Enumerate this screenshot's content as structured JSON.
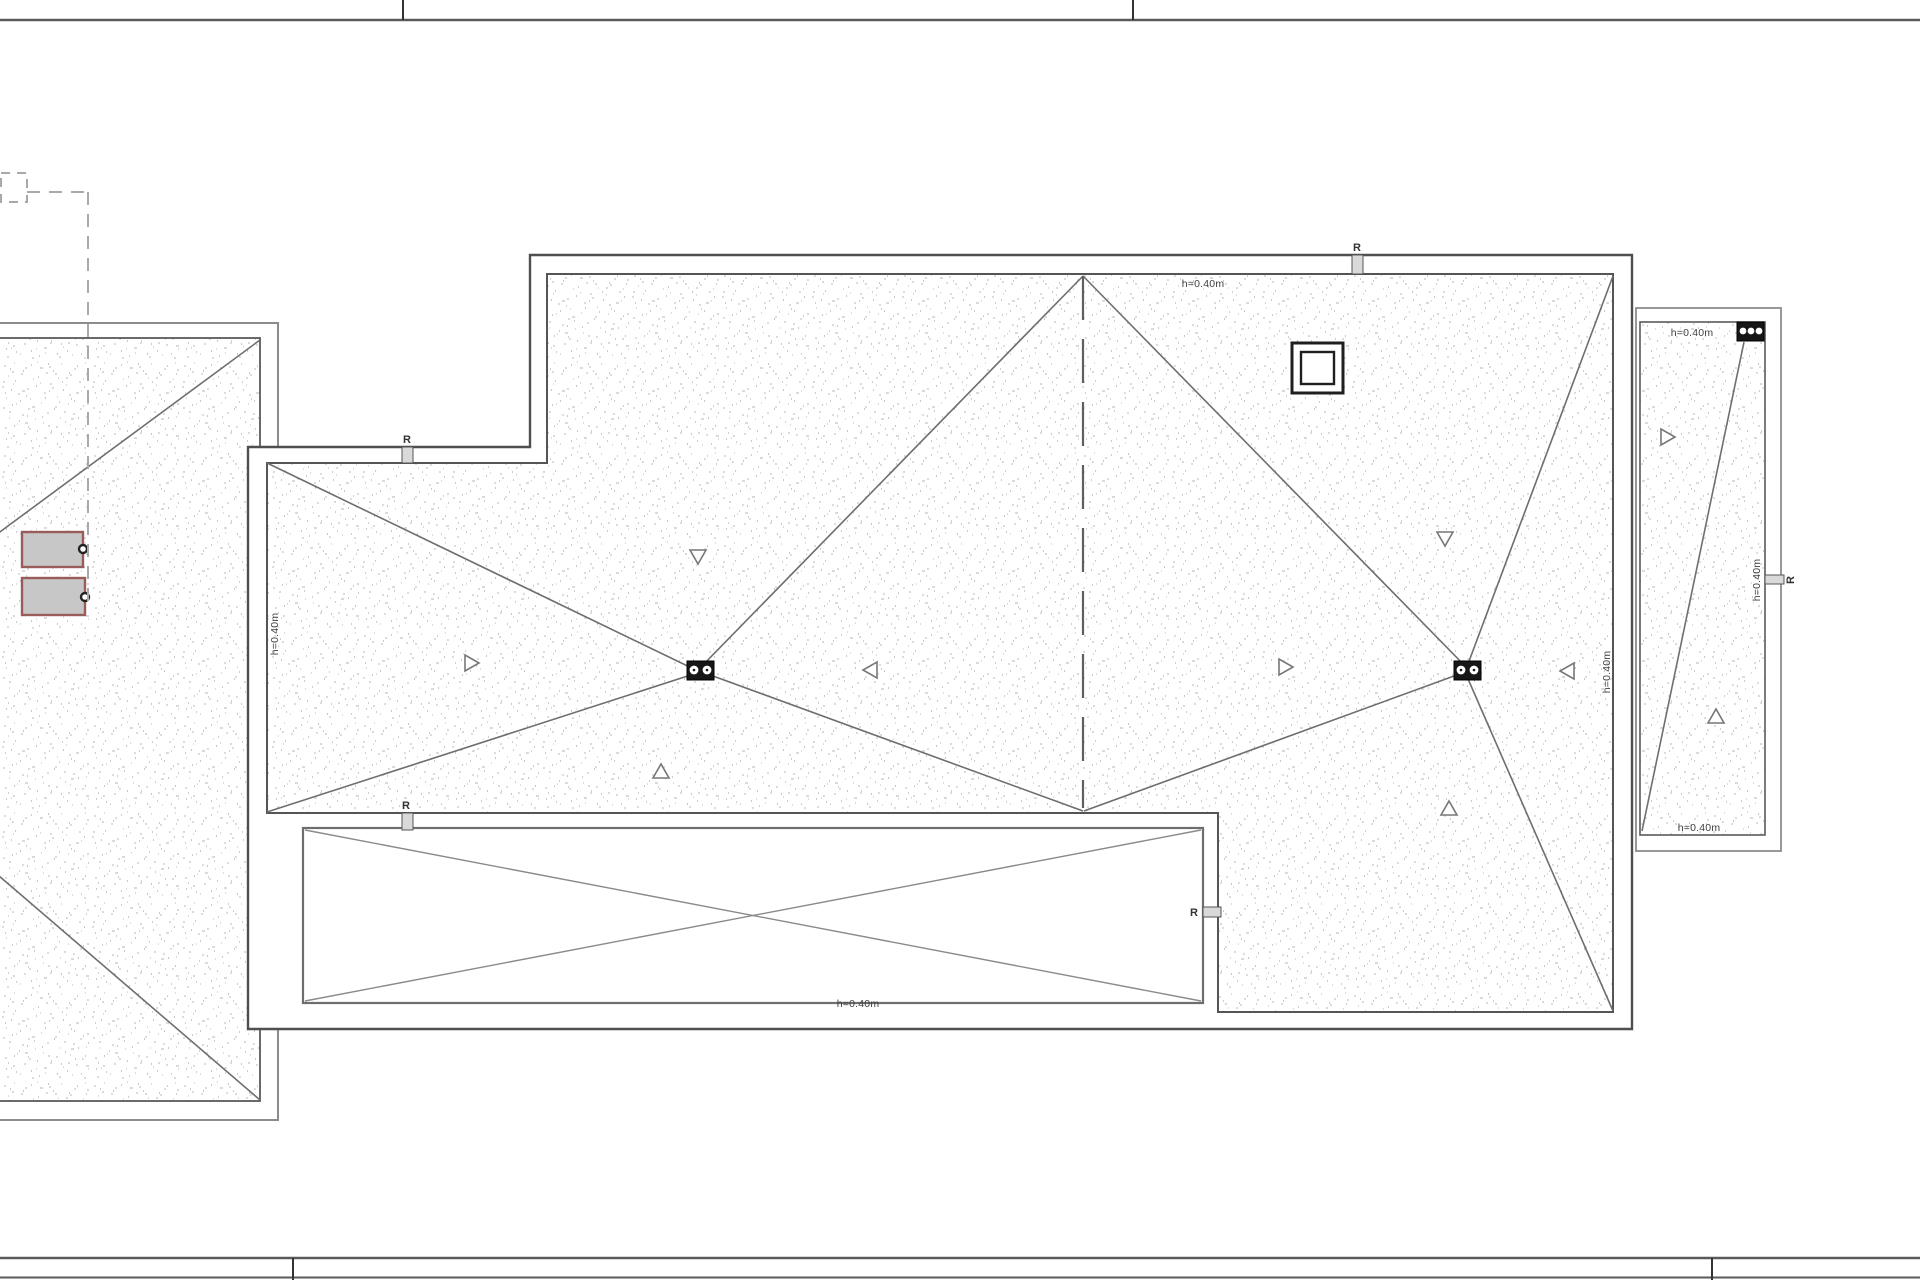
{
  "drawing": {
    "type": "roof-plan",
    "labels": {
      "main_top": "h=0.40m",
      "main_left": "h=0.40m",
      "main_right": "h=0.40m",
      "terrace_bottom": "h=0.40m",
      "panel_top": "h=0.40m",
      "panel_bottom": "h=0.40m",
      "panel_side": "h=0.40m"
    },
    "markers": {
      "top": "R",
      "step": "R",
      "lower_left": "R",
      "terrace": "R",
      "panel": "R"
    },
    "colors": {
      "outline_dark": "#4f4f4f",
      "outline_mid": "#6f6f6f",
      "outline_light": "#8c8c8c",
      "text": "#3f3f3f",
      "marker_fill": "#d9d9d9",
      "drain_fill": "#161616",
      "skylight_border": "#9a5b5b",
      "skylight_fill": "#c7c7c7",
      "dashed_reference": "#a9a9a9",
      "stipple_dots": "#b8b8b8"
    }
  }
}
